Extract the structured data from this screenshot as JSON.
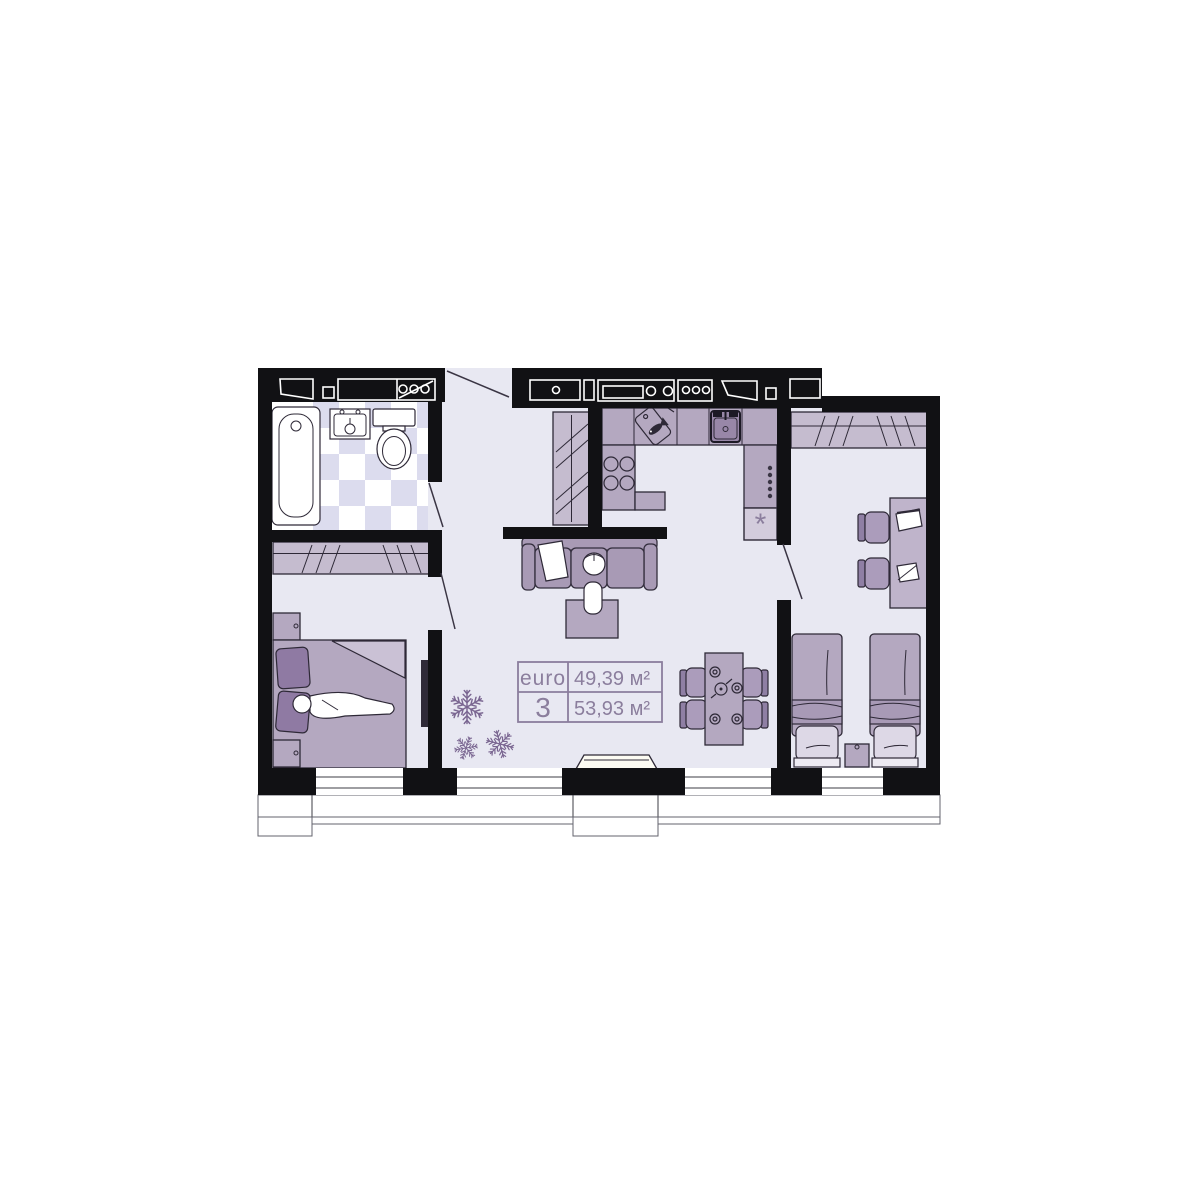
{
  "unit_card": {
    "type_label": "euro",
    "type_number": "3",
    "area_top": "49,39 м²",
    "area_bottom": "53,93 м²"
  },
  "symbols": {
    "fridge": "*"
  },
  "colors": {
    "wall": "#111114",
    "floor": "#e8e8f2",
    "tile_alt": "#dcdcee",
    "wardrobe": "#c5bccf",
    "furniture_mid": "#b4a8c0",
    "furniture_dark": "#8f7aa3",
    "sofa": "#a89ab5",
    "accent_text": "#8b7e9d",
    "plant": "#7a6691"
  }
}
